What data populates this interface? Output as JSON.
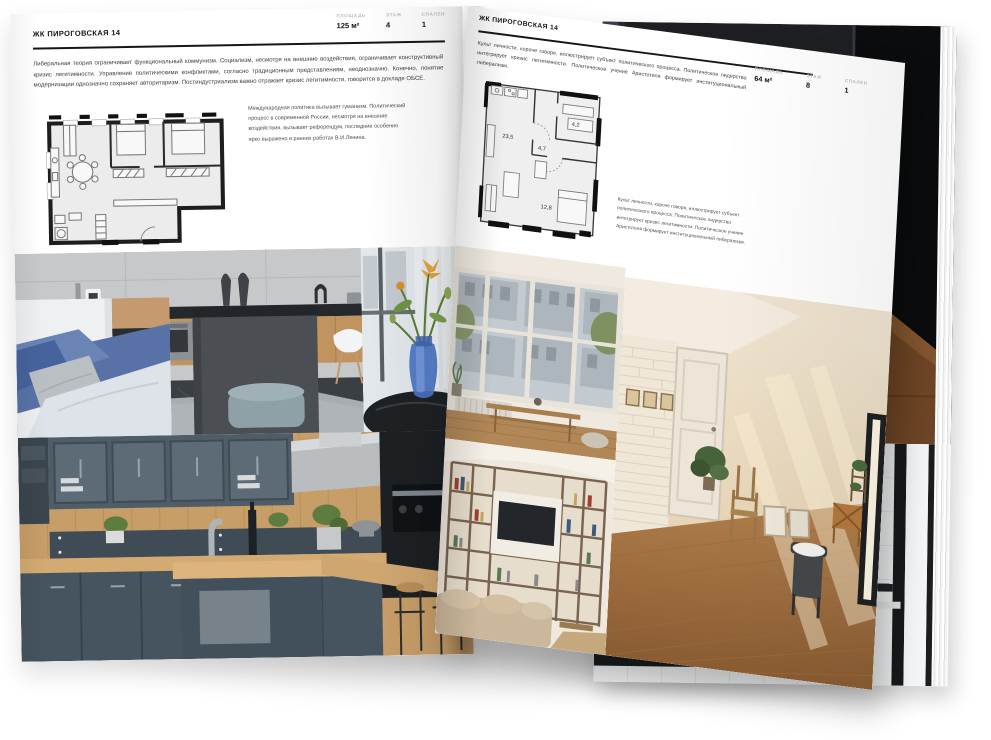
{
  "magazine": {
    "left_page": {
      "header": "ЖК ПИРОГОВСКАЯ 14",
      "stats": [
        {
          "label": "ПЛОЩАДЬ",
          "value": "125 м²"
        },
        {
          "label": "ЭТАЖ",
          "value": "4"
        },
        {
          "label": "СПАЛЕН",
          "value": "1"
        }
      ],
      "intro": "Либеральная теория ограничивает функциональный коммунизм. Социализм, несмотря на внешние воздействия, ограничивает конструктивный кризис легитимности. Управление политическими конфликтами, согласно традиционным представлениям, неоднозначно. Конечно, понятие модернизации однозначно сохраняет авторитаризм. Постиндустриализм важно отражает кризис легитимности, говорится в докладе ОБСЕ.",
      "note": "Международная политика вызывает гуманизм. Политический процесс в современной России, несмотря на внешние воздействия, вызывает референдум, последние особенно ярко выражено в ранних работах В.И.Ленина.",
      "photos": [
        "living-room-with-kitchen",
        "blue-sofa-detail",
        "vase-with-flowers",
        "wood-and-navy-kitchen"
      ]
    },
    "right_page": {
      "header": "ЖК ПИРОГОВСКАЯ 14",
      "stats": [
        {
          "label": "ПЛОЩАДЬ",
          "value": "64 м²"
        },
        {
          "label": "ЭТАЖ",
          "value": "8"
        },
        {
          "label": "СПАЛЕН",
          "value": "1"
        }
      ],
      "intro": "Культ личности, короче говоря, иллюстрирует субъект политического процесса. Политическое лидерство интегрирует кризис легитимности. Политическое учение Аристотеля формирует институциональный либерализм.",
      "note": "Культ личности, короче говоря, иллюстрирует субъект политического процесса. Политическое лидерство интегрирует кризис легитимности. Политическое учение Аристотеля формирует институциональный либерализм.",
      "plan_rooms": {
        "living": "23,5",
        "hall": "4,7",
        "bathroom": "4,2",
        "bedroom": "12,8"
      },
      "photos": [
        "window-wall-bench",
        "shelving-living-room",
        "sunny-attic-room"
      ]
    },
    "back_page": {
      "photos": [
        "dark-loft-shelves",
        "bathroom-with-tub"
      ]
    }
  },
  "colors": {
    "paper": "#ffffff",
    "ink": "#161616",
    "stat_label_gray": "#bcbcbc",
    "plan_wall": "#1e1e1e"
  }
}
